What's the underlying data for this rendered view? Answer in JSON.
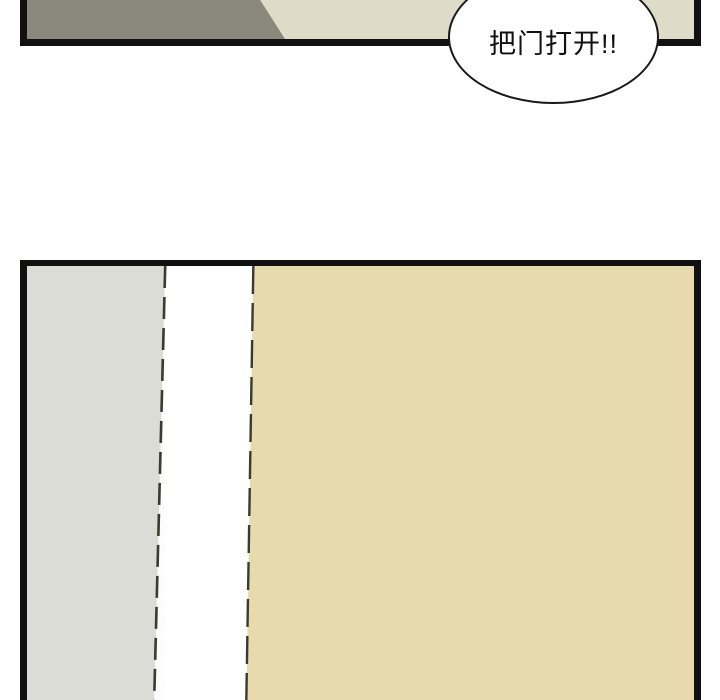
{
  "speech_bubble": {
    "text": "把门打开!!"
  },
  "panels": {
    "top": {
      "description": "corridor wall, dark and light sections"
    },
    "bottom": {
      "description": "door close-up: gray wall strip, white gap, beige door"
    }
  },
  "colors": {
    "ink": "#111111",
    "panel-top-dark": "#8a877b",
    "panel-top-light": "#dedcc8",
    "panel-bottom-beige": "#e7dbae",
    "panel-bottom-gray": "#dcddd7",
    "divider-dark": "#3a3a2e",
    "bubble-fill": "#ffffff",
    "bubble-stroke": "#1a1a1a",
    "page-bg": "#ffffff"
  }
}
